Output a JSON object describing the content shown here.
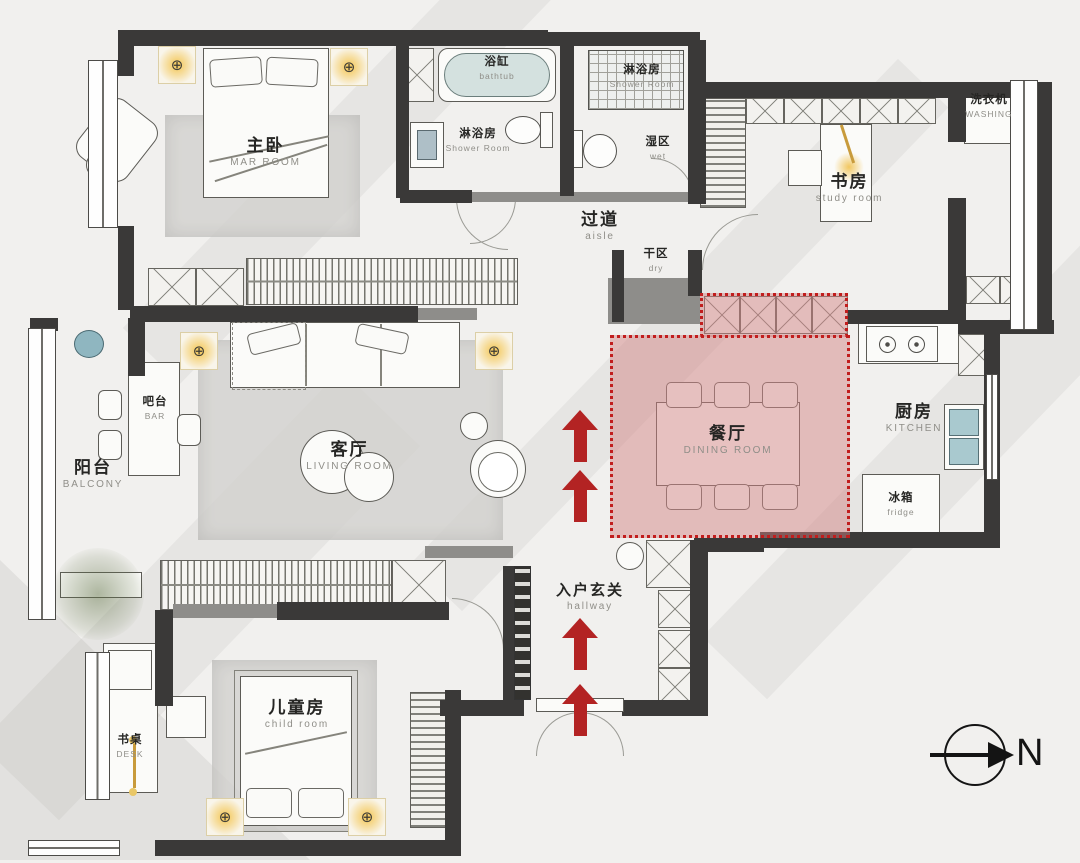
{
  "title": "apartment-floor-plan",
  "rooms": {
    "master_bedroom": {
      "zh": "主卧",
      "en": "MAR ROOM"
    },
    "bathtub": {
      "zh": "浴缸",
      "en": "bathtub"
    },
    "shower_room_main": {
      "zh": "淋浴房",
      "en": "Shower Room"
    },
    "shower_room_guest": {
      "zh": "淋浴房",
      "en": "Shower Room"
    },
    "wet_zone": {
      "zh": "湿区",
      "en": "wet"
    },
    "aisle": {
      "zh": "过道",
      "en": "aisle"
    },
    "study_room": {
      "zh": "书房",
      "en": "study room"
    },
    "washing": {
      "zh": "洗衣机",
      "en": "WASHING"
    },
    "dry_zone": {
      "zh": "干区",
      "en": "dry"
    },
    "dining_room": {
      "zh": "餐厅",
      "en": "DINING ROOM"
    },
    "kitchen": {
      "zh": "厨房",
      "en": "KITCHEN"
    },
    "fridge": {
      "zh": "冰箱",
      "en": "fridge"
    },
    "living_room": {
      "zh": "客厅",
      "en": "LIVING ROOM"
    },
    "bar": {
      "zh": "吧台",
      "en": "BAR"
    },
    "balcony": {
      "zh": "阳台",
      "en": "BALCONY"
    },
    "entry_hall": {
      "zh": "入户玄关",
      "en": "hallway"
    },
    "child_room": {
      "zh": "儿童房",
      "en": "child room"
    },
    "desk": {
      "zh": "书桌",
      "en": "DESK"
    }
  },
  "compass": {
    "north_label": "N"
  },
  "icons": {
    "ceiling_light_symbol": "⊕"
  },
  "colors": {
    "highlight_fill": "#d28282",
    "highlight_border": "#c11d1d",
    "arrow_red": "#b32323",
    "wall_dark": "#3a3938",
    "light_glow": "#f3c34a"
  }
}
